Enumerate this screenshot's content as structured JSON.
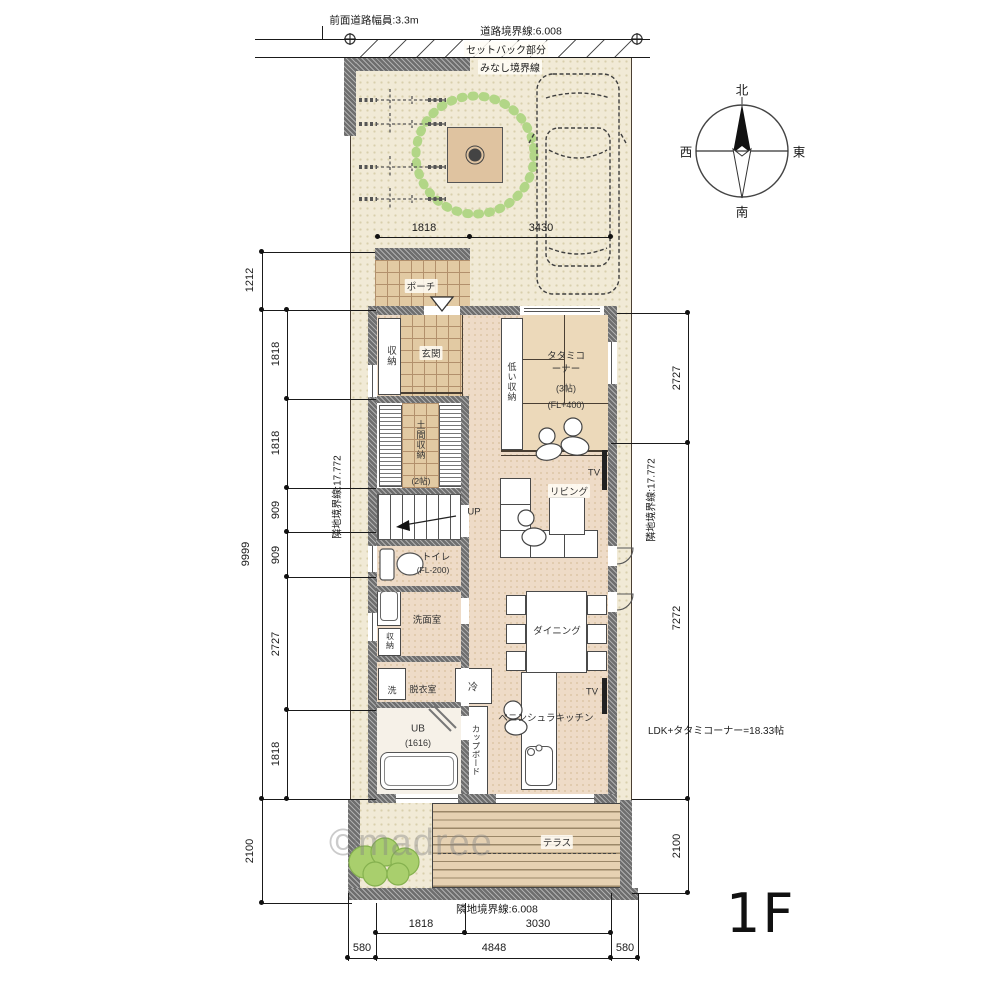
{
  "floor": {
    "label": "1F"
  },
  "watermark": {
    "text": "©madree"
  },
  "compass": {
    "north": "北",
    "south": "南",
    "east": "東",
    "west": "西"
  },
  "boundaries": {
    "front_road": "前面道路幅員:3.3m",
    "road": "道路境界線:6.008",
    "setback": "セットバック部分",
    "minashi": "みなし境界線",
    "left": "隣地境界線:17.772",
    "right": "隣地境界線:17.772",
    "bottom": "隣地境界線:6.008"
  },
  "dims": {
    "top": [
      "1818",
      "3430"
    ],
    "left_outer": [
      "1212",
      "9999",
      "2100"
    ],
    "left_inner": [
      "1818",
      "1818",
      "909",
      "909",
      "2727",
      "1818"
    ],
    "right_outer": [
      "2727",
      "7272",
      "2100"
    ],
    "bottom_inner": [
      "1818",
      "3030"
    ],
    "bottom_outer": [
      "580",
      "4848",
      "580"
    ]
  },
  "rooms": {
    "porch": "ポーチ",
    "entrance": "玄関",
    "entrance_storage": "収納",
    "doma": "土間収納",
    "doma_size": "(2帖)",
    "stairs_up": "UP",
    "toilet": "トイレ",
    "toilet_fl": "(FL-200)",
    "washroom": "洗面室",
    "wash_storage": "収納",
    "washer": "洗",
    "dressing": "脱衣室",
    "fridge": "冷",
    "bath": "UB",
    "bath_size": "(1616)",
    "cupboard": "カップボード",
    "kitchen": "ペニンシュラキッチン",
    "dining": "ダイニング",
    "living": "リビング",
    "tv_living": "TV",
    "tv_dining": "TV",
    "low_storage": "低い収納",
    "tatami": "タタミコーナー",
    "tatami_size": "(3帖)",
    "tatami_fl": "(FL+400)",
    "terrace": "テラス"
  },
  "notes": {
    "ldk_area": "LDK+タタミコーナー=18.33帖"
  },
  "colors": {
    "wall": "#6e6e6e",
    "site": "#f1ead6",
    "floor": "#eedbc7",
    "tree": "#b2d687",
    "bush": "#a9cf6d",
    "deck": "#e6d1b2"
  }
}
